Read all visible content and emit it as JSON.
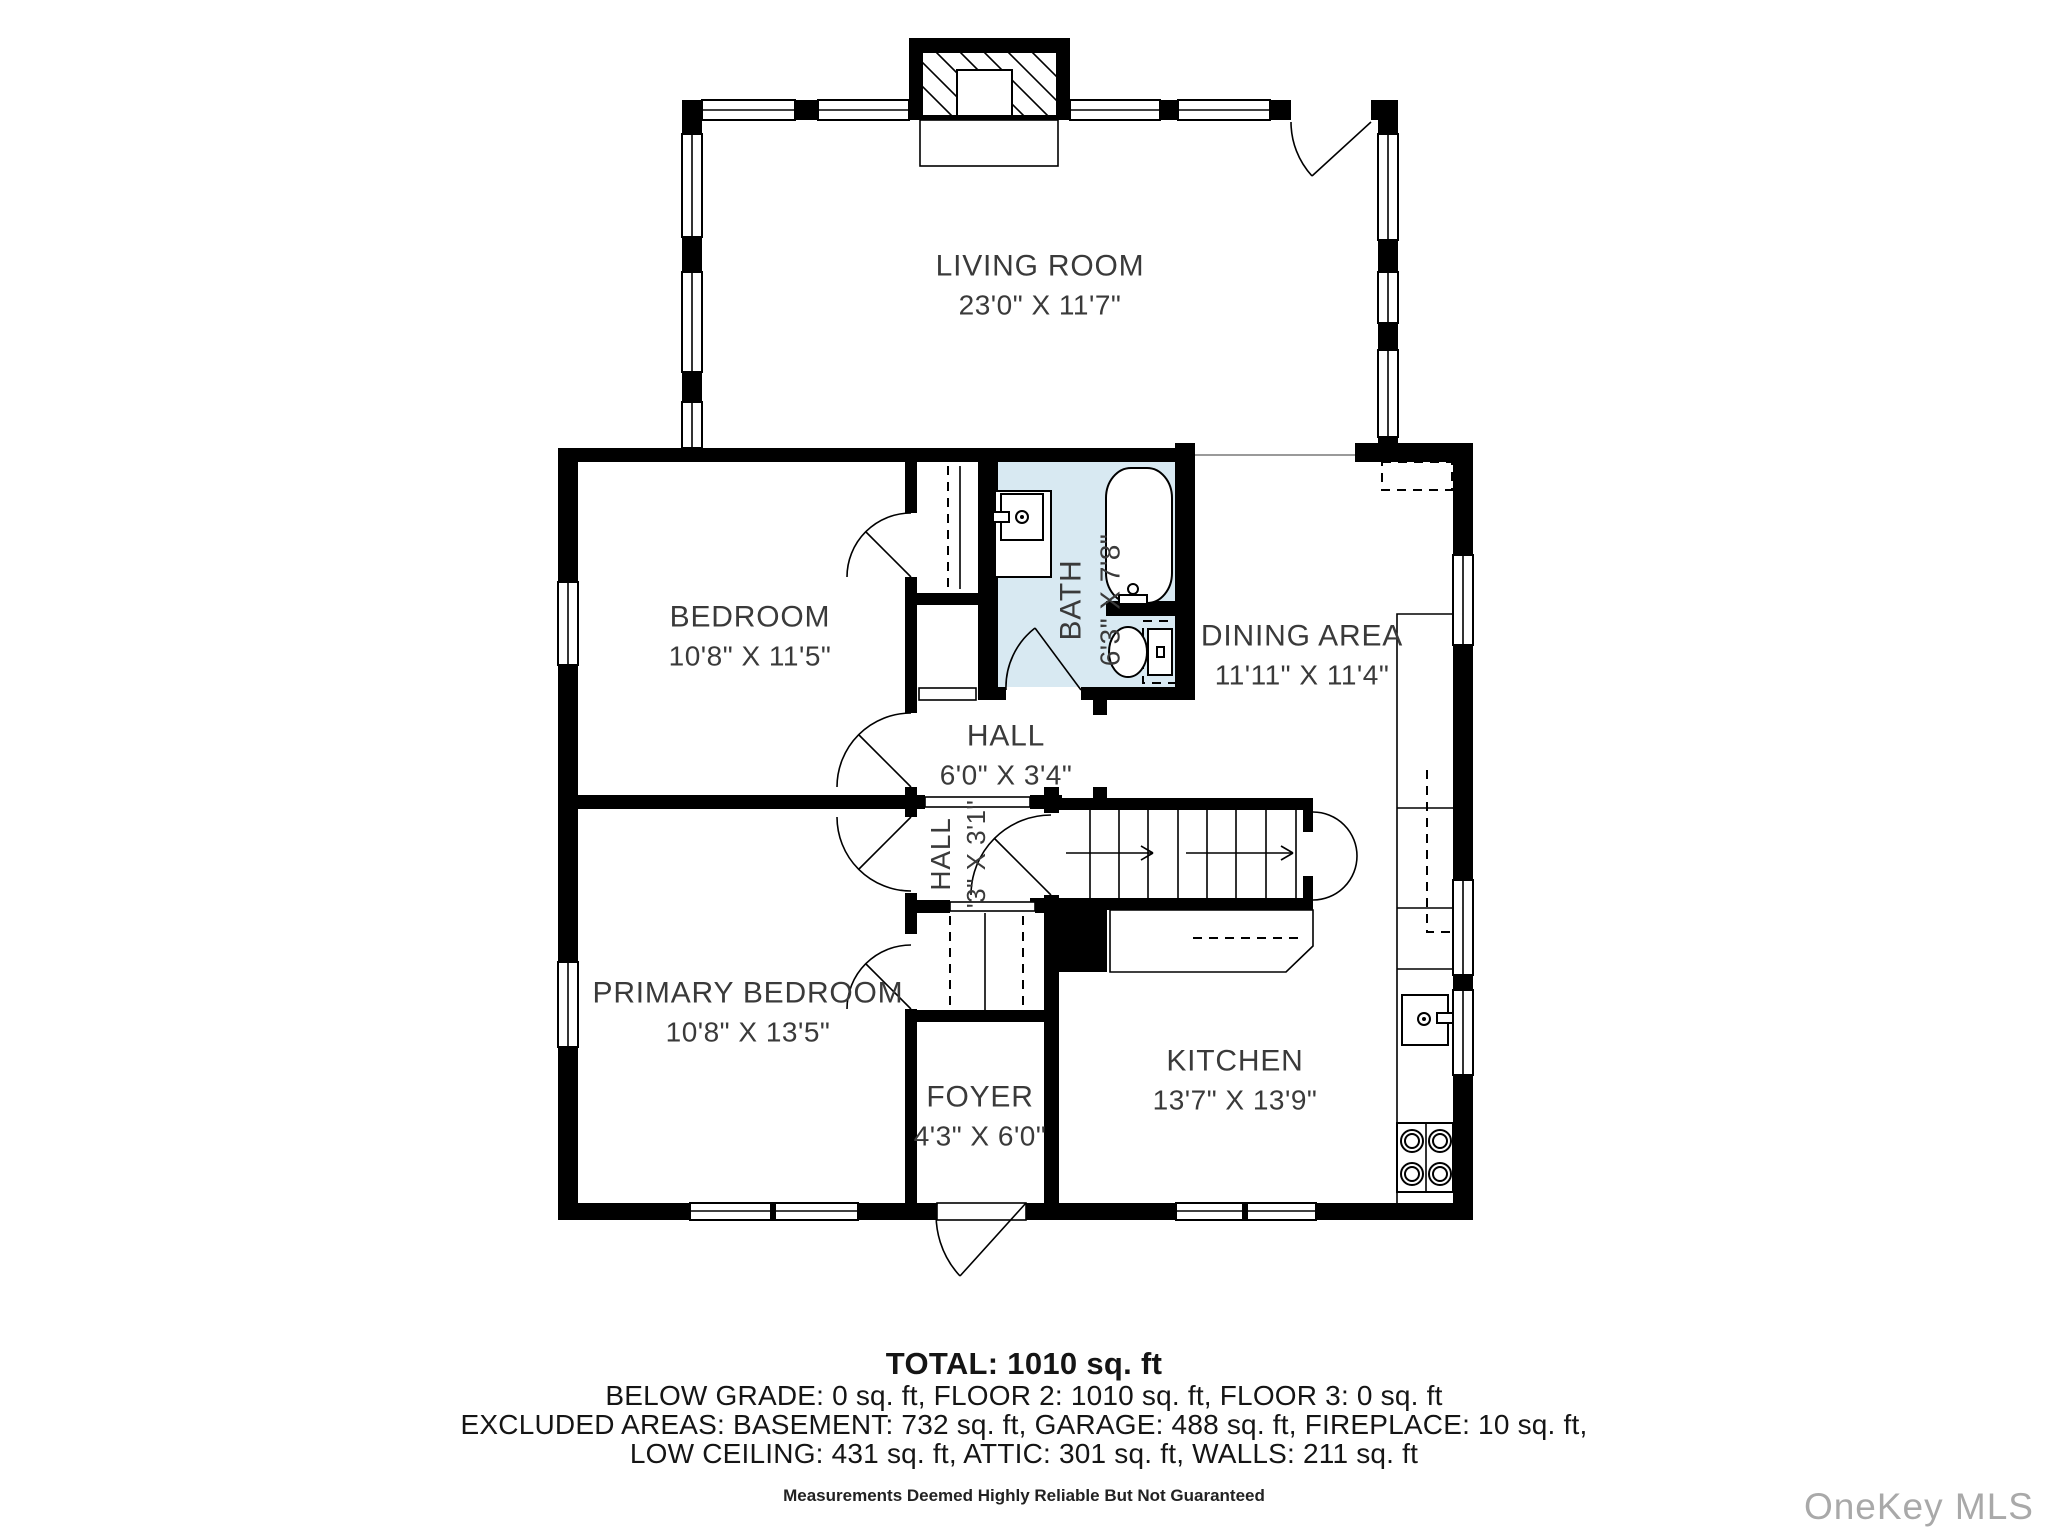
{
  "rooms": {
    "living_room": {
      "name": "LIVING ROOM",
      "dims": "23'0\" X 11'7\""
    },
    "bedroom": {
      "name": "BEDROOM",
      "dims": "10'8\" X 11'5\""
    },
    "bath": {
      "name": "BATH",
      "dims": "6'3\" X 7'8\""
    },
    "dining_area": {
      "name": "DINING AREA",
      "dims": "11'11\" X 11'4\""
    },
    "hall_upper": {
      "name": "HALL",
      "dims": "6'0\" X 3'4\""
    },
    "hall_lower": {
      "name": "HALL",
      "dims": "'3\" X 3'1\""
    },
    "primary_bedroom": {
      "name": "PRIMARY BEDROOM",
      "dims": "10'8\" X 13'5\""
    },
    "foyer": {
      "name": "FOYER",
      "dims": "4'3\" X 6'0\""
    },
    "kitchen": {
      "name": "KITCHEN",
      "dims": "13'7\" X 13'9\""
    }
  },
  "summary": {
    "total": "TOTAL: 1010 sq. ft",
    "line1": "BELOW GRADE: 0 sq. ft, FLOOR 2: 1010 sq. ft, FLOOR 3: 0 sq. ft",
    "line2": "EXCLUDED AREAS: BASEMENT: 732 sq. ft, GARAGE: 488 sq. ft, FIREPLACE: 10 sq. ft,",
    "line3": "LOW CEILING: 431 sq. ft, ATTIC: 301 sq. ft, WALLS: 211 sq. ft",
    "disclaimer": "Measurements Deemed Highly Reliable But Not Guaranteed"
  },
  "watermark": "OneKey MLS",
  "colors": {
    "bath_fill": "#d8e9f2",
    "wall": "#000000",
    "label_text": "#3a3a3a",
    "watermark": "#a9a9a9"
  }
}
